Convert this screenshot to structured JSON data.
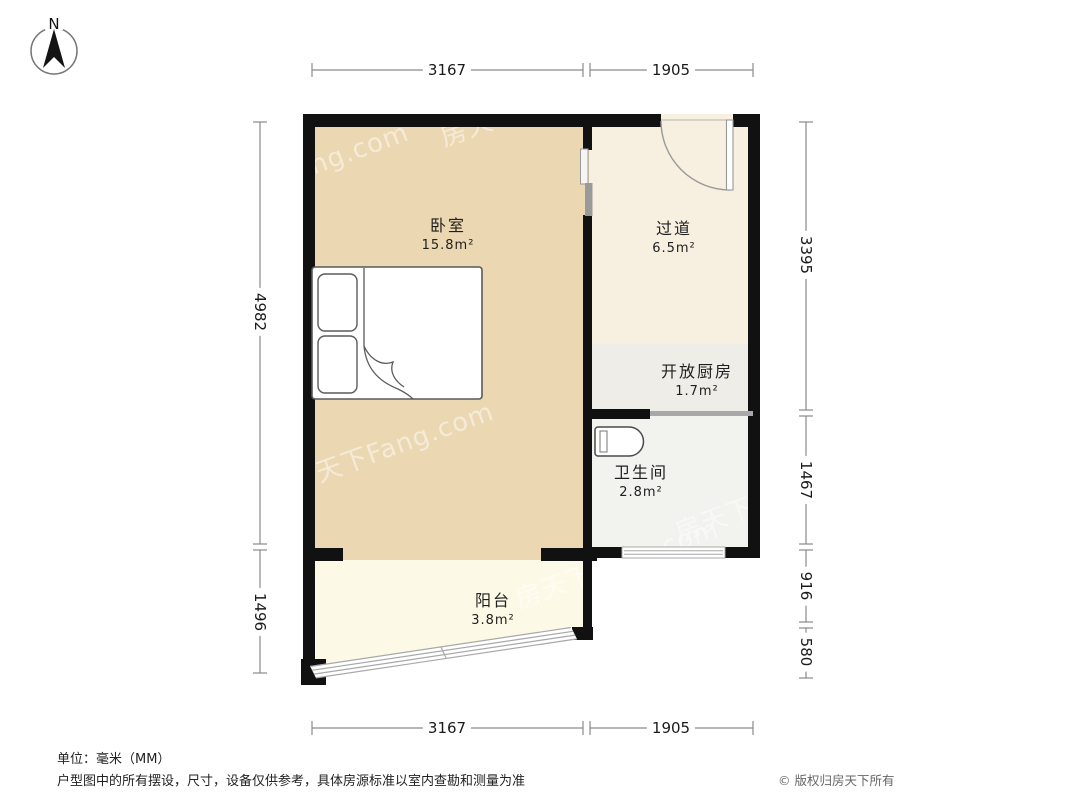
{
  "compass": {
    "label": "N"
  },
  "rooms": [
    {
      "id": "bedroom",
      "name": "卧室",
      "area": "15.8m²"
    },
    {
      "id": "hallway",
      "name": "过道",
      "area": "6.5m²"
    },
    {
      "id": "kitchen",
      "name": "开放厨房",
      "area": "1.7m²"
    },
    {
      "id": "bathroom",
      "name": "卫生间",
      "area": "2.8m²"
    },
    {
      "id": "balcony",
      "name": "阳台",
      "area": "3.8m²"
    }
  ],
  "dimensions": {
    "top": [
      "3167",
      "1905"
    ],
    "bottom": [
      "3167",
      "1905"
    ],
    "left": [
      "4982",
      "1496"
    ],
    "right": [
      "3395",
      "1467",
      "916",
      "580"
    ]
  },
  "watermark": {
    "text": "房天下Fang.com"
  },
  "footer": {
    "unit_note": "单位：毫米（MM）",
    "disclaimer": "户型图中的所有摆设，尺寸，设备仅供参考，具体房源标准以室内查勘和测量为准",
    "copyright": "© 版权归房天下所有"
  },
  "colors": {
    "wall": "#111111",
    "bedroom_floor": "#ebd7b1",
    "hallway_floor": "#f7efe0",
    "kitchen_floor": "#efede8",
    "bathroom_floor": "#f2f2ef",
    "balcony_floor": "#fdf9e7",
    "counter": "#a9a9a9",
    "dimension_line": "#8a8a8a",
    "fixture_stroke": "#555555"
  }
}
